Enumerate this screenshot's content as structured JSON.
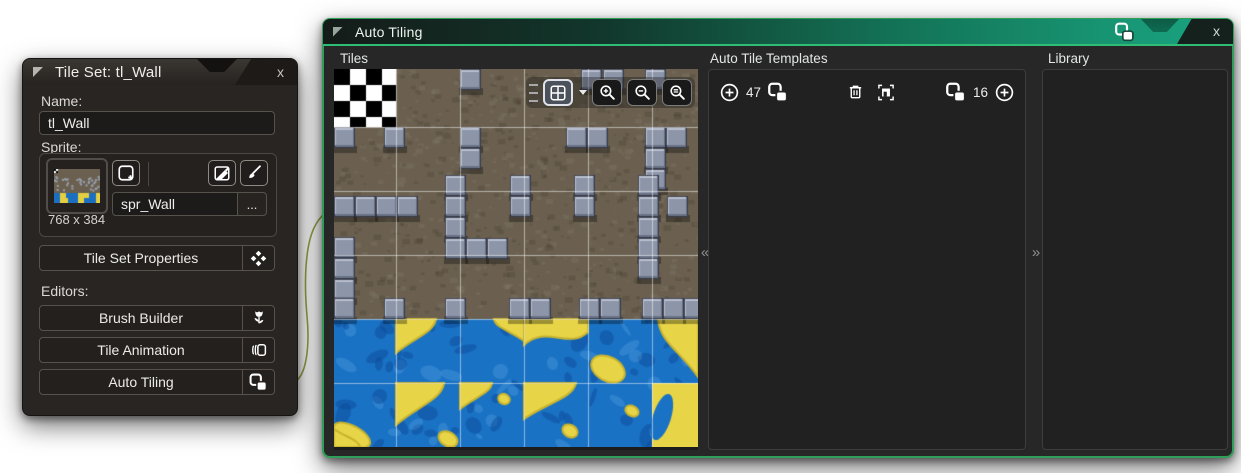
{
  "left_window": {
    "title": "Tile Set: tl_Wall",
    "close_label": "x",
    "name_label": "Name:",
    "name_value": "tl_Wall",
    "sprite_label": "Sprite:",
    "sprite_name": "spr_Wall",
    "browse_label": "...",
    "sprite_size": "768 x 384",
    "properties_label": "Tile Set Properties",
    "editors_label": "Editors:",
    "editors": [
      {
        "label": "Brush Builder",
        "icon": "tulip-icon"
      },
      {
        "label": "Tile Animation",
        "icon": "card-stack-icon"
      },
      {
        "label": "Auto Tiling",
        "icon": "autotile-icon"
      }
    ],
    "icons": [
      "collapse-triangle-icon",
      "add-sprite-icon",
      "edit-sprite-icon",
      "paintbrush-icon",
      "four-diamonds-icon"
    ]
  },
  "right_window": {
    "title": "Auto Tiling",
    "close_label": "x",
    "tiles_label": "Tiles",
    "templates_label": "Auto Tile Templates",
    "count_47": "47",
    "count_16": "16",
    "library_label": "Library",
    "collapse_left": "«",
    "collapse_right": "»",
    "tiles_toolbar_icons": [
      "drag-handle-icon",
      "grid-options-icon",
      "zoom-in-icon",
      "zoom-out-icon",
      "zoom-reset-icon"
    ],
    "templates_toolbar_icons": [
      "add-circle-icon",
      "autotile-icon",
      "trash-icon",
      "template-frame-icon",
      "autotile-icon",
      "add-circle-icon"
    ],
    "titlebar_icon": "autotile-icon"
  },
  "colors": {
    "accent_green_border": "#2f9e58",
    "titlebar_teal": "#1aa583",
    "titlebar_underline": "#2fbd75",
    "wire_green": "#8ea03a",
    "panel_bg": "#212121",
    "window_bg": "#272727"
  },
  "tileset_preview": {
    "width": 364,
    "height": 378,
    "grid_x": [
      62,
      126,
      190,
      254,
      318
    ],
    "grid_y": [
      58,
      122,
      186,
      250,
      314
    ],
    "checker": {
      "x": 0,
      "y": 0,
      "w": 62,
      "h": 58,
      "size": 16
    },
    "dirt_bottom": 250,
    "dirt_color": "#6b604f",
    "block_size": 21,
    "blocks": [
      [
        126,
        0
      ],
      [
        247,
        0
      ],
      [
        269,
        0
      ],
      [
        311,
        0
      ],
      [
        0,
        58
      ],
      [
        50,
        58
      ],
      [
        126,
        58
      ],
      [
        232,
        58
      ],
      [
        253,
        58
      ],
      [
        311,
        58
      ],
      [
        332,
        58
      ],
      [
        126,
        79
      ],
      [
        311,
        79
      ],
      [
        311,
        100
      ],
      [
        111,
        106
      ],
      [
        176,
        106
      ],
      [
        240,
        106
      ],
      [
        304,
        106
      ],
      [
        0,
        127
      ],
      [
        21,
        127
      ],
      [
        42,
        127
      ],
      [
        63,
        127
      ],
      [
        111,
        127
      ],
      [
        176,
        127
      ],
      [
        240,
        127
      ],
      [
        304,
        127
      ],
      [
        333,
        127
      ],
      [
        111,
        148
      ],
      [
        304,
        148
      ],
      [
        111,
        169
      ],
      [
        132,
        169
      ],
      [
        153,
        169
      ],
      [
        304,
        169
      ],
      [
        0,
        168
      ],
      [
        0,
        189
      ],
      [
        304,
        189
      ],
      [
        0,
        210
      ],
      [
        0,
        229
      ],
      [
        50,
        229
      ],
      [
        111,
        229
      ],
      [
        175,
        229
      ],
      [
        196,
        229
      ],
      [
        245,
        229
      ],
      [
        266,
        229
      ],
      [
        308,
        229
      ],
      [
        329,
        229
      ],
      [
        350,
        229
      ]
    ],
    "water": {
      "top": 250,
      "row_h": 64,
      "cols": [
        0,
        62,
        126,
        190,
        254,
        318
      ],
      "col_w": [
        62,
        64,
        64,
        64,
        64,
        46
      ],
      "blue": "#1a72c4",
      "blue_dark": "#0d4f9b",
      "yellow": "#e8d447",
      "yellow_dark": "#c9b42e",
      "blobs": [
        {
          "col": 1,
          "row": 0,
          "kind": "corner-tl",
          "w": 40,
          "h": 34
        },
        {
          "col": 2,
          "row": 0,
          "kind": "corner-tr",
          "w": 30,
          "h": 22
        },
        {
          "col": 3,
          "row": 0,
          "kind": "band-top",
          "h": 26
        },
        {
          "col": 4,
          "row": 0,
          "kind": "dot",
          "x": 20,
          "y": 50,
          "rx": 18,
          "ry": 12
        },
        {
          "col": 5,
          "row": 0,
          "kind": "corner-tr",
          "w": 40,
          "h": 58
        },
        {
          "col": 0,
          "row": 1,
          "kind": "dot",
          "x": 18,
          "y": 52,
          "rx": 20,
          "ry": 9
        },
        {
          "col": 1,
          "row": 1,
          "kind": "corner-tl",
          "w": 48,
          "h": 42
        },
        {
          "col": 1,
          "row": 1,
          "kind": "dot",
          "x": 52,
          "y": 56,
          "rx": 10,
          "ry": 7
        },
        {
          "col": 2,
          "row": 1,
          "kind": "corner-tl",
          "w": 32,
          "h": 26
        },
        {
          "col": 2,
          "row": 1,
          "kind": "dot",
          "x": 44,
          "y": 16,
          "rx": 6,
          "ry": 5
        },
        {
          "col": 3,
          "row": 1,
          "kind": "corner-tl",
          "w": 52,
          "h": 36
        },
        {
          "col": 3,
          "row": 1,
          "kind": "dot",
          "x": 46,
          "y": 48,
          "rx": 8,
          "ry": 6
        },
        {
          "col": 4,
          "row": 1,
          "kind": "dot",
          "x": 44,
          "y": 28,
          "rx": 7,
          "ry": 5
        },
        {
          "col": 0,
          "row": 1,
          "kind": "corner-bl",
          "w": 26,
          "h": 18
        },
        {
          "col": 5,
          "row": 1,
          "kind": "fill",
          "blue_streak": true
        }
      ]
    }
  }
}
